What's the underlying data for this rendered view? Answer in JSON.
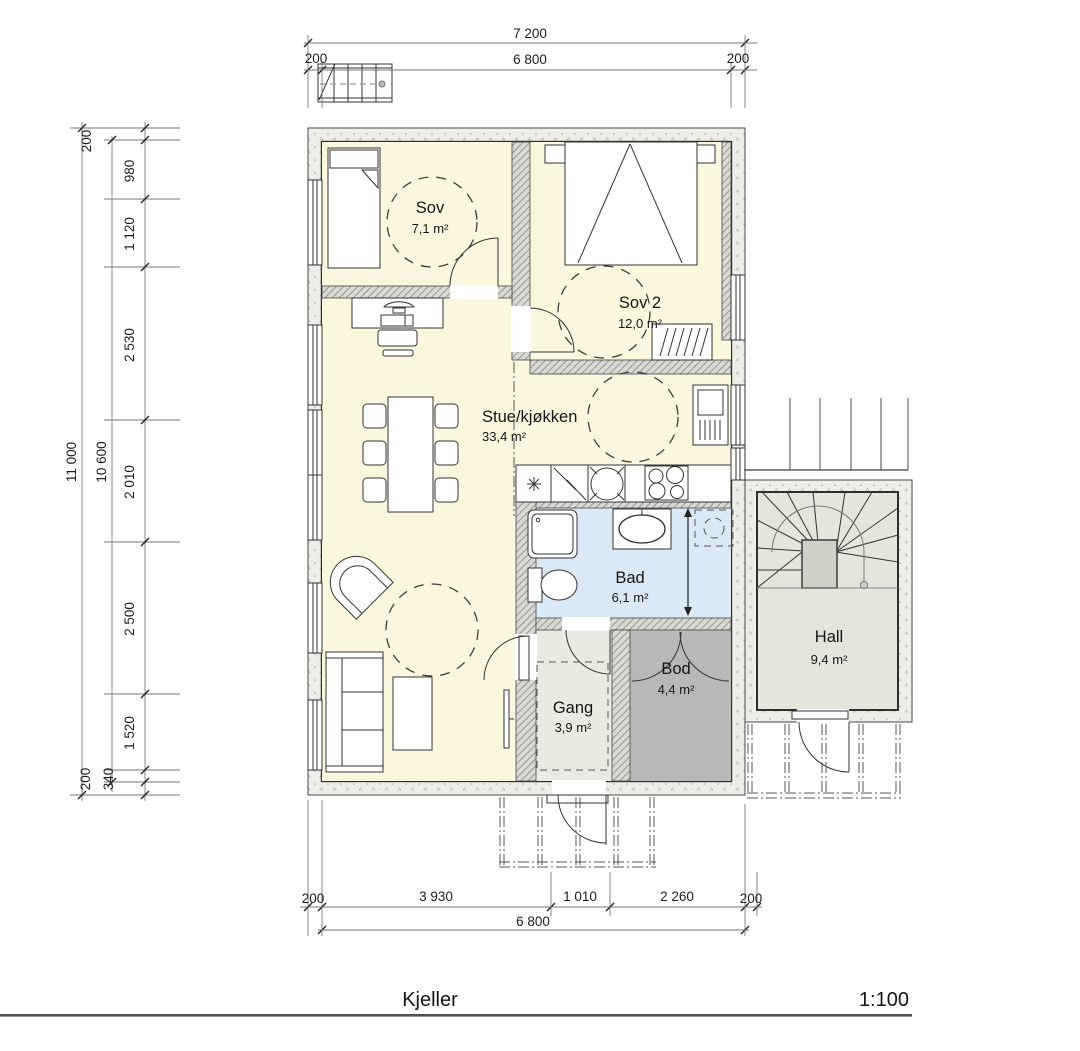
{
  "footer": {
    "title": "Kjeller",
    "scale": "1:100"
  },
  "rooms": {
    "sov": {
      "name": "Sov",
      "area": "7,1 m²"
    },
    "sov2": {
      "name": "Sov 2",
      "area": "12,0 m²"
    },
    "stue": {
      "name": "Stue/kjøkken",
      "area": "33,4 m²"
    },
    "bad": {
      "name": "Bad",
      "area": "6,1 m²"
    },
    "gang": {
      "name": "Gang",
      "area": "3,9 m²"
    },
    "bod": {
      "name": "Bod",
      "area": "4,4 m²"
    },
    "hall": {
      "name": "Hall",
      "area": "9,4 m²"
    }
  },
  "dimensions": {
    "top": {
      "overall": "7 200",
      "inner": "6 800",
      "left": "200",
      "right": "200"
    },
    "left": {
      "overall": "11 000",
      "inner": "10 600",
      "segments": [
        "200",
        "980",
        "1 120",
        "2 530",
        "2 010",
        "2 500",
        "1 520",
        "340",
        "200"
      ]
    },
    "bottom": {
      "segments": [
        "200",
        "3 930",
        "1 010",
        "2 260",
        "200"
      ],
      "inner": "6 800"
    }
  },
  "colors": {
    "bedroom_fill": "#fbf7de",
    "bath_fill": "#dbe9f6",
    "gang_fill": "#e9eae1",
    "bod_fill": "#b8b8b6",
    "hall_fill": "#e4e5db"
  }
}
